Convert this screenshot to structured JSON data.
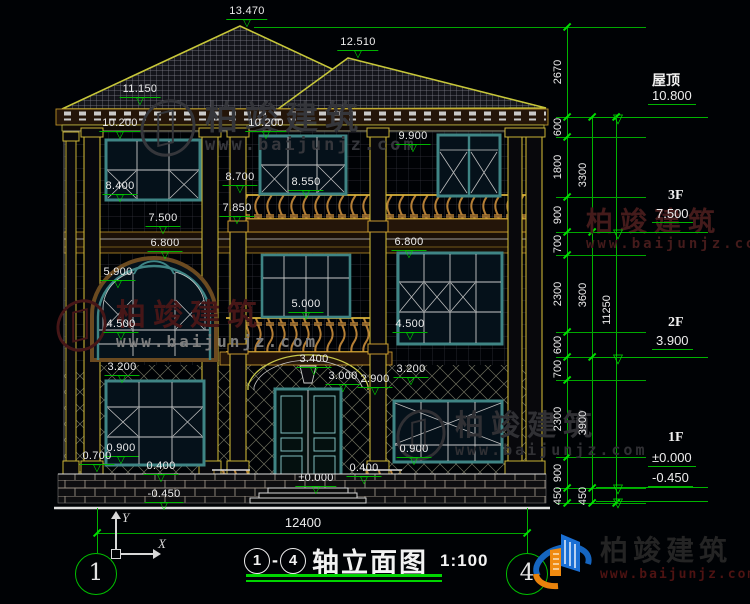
{
  "page": {
    "background": "#000205"
  },
  "brand": {
    "name": "柏竣建筑",
    "url": "www.baijunjz.com"
  },
  "title_block": {
    "axis_from": "1",
    "axis_to": "4",
    "separator": "-",
    "title": "轴立面图",
    "scale": "1:100"
  },
  "ucs": {
    "y_label": "Y",
    "x_label": "X"
  },
  "bottom_dim": {
    "label": "12400",
    "x1": 97,
    "x2": 527,
    "y": 533,
    "label_cx": 303,
    "label_y": 515
  },
  "axis_bubbles": [
    {
      "label": "1",
      "cx": 95,
      "cy": 573
    },
    {
      "label": "4",
      "cx": 526,
      "cy": 573
    }
  ],
  "elevation_marks": [
    {
      "label": "13.470",
      "cx": 247,
      "ty": 5
    },
    {
      "label": "12.510",
      "cx": 358,
      "ty": 36
    },
    {
      "label": "11.150",
      "cx": 140,
      "ty": 83
    },
    {
      "label": "10.200",
      "cx": 120,
      "ty": 117
    },
    {
      "label": "10.200",
      "cx": 266,
      "ty": 117
    },
    {
      "label": "9.900",
      "cx": 413,
      "ty": 130
    },
    {
      "label": "8.700",
      "cx": 240,
      "ty": 171
    },
    {
      "label": "8.550",
      "cx": 306,
      "ty": 176
    },
    {
      "label": "8.400",
      "cx": 120,
      "ty": 180
    },
    {
      "label": "7.850",
      "cx": 237,
      "ty": 202
    },
    {
      "label": "7.500",
      "cx": 163,
      "ty": 212
    },
    {
      "label": "6.800",
      "cx": 165,
      "ty": 237
    },
    {
      "label": "6.800",
      "cx": 409,
      "ty": 236
    },
    {
      "label": "5.900",
      "cx": 118,
      "ty": 266
    },
    {
      "label": "5.000",
      "cx": 306,
      "ty": 298
    },
    {
      "label": "4.500",
      "cx": 121,
      "ty": 318
    },
    {
      "label": "4.500",
      "cx": 410,
      "ty": 318
    },
    {
      "label": "3.400",
      "cx": 314,
      "ty": 353
    },
    {
      "label": "3.200",
      "cx": 122,
      "ty": 361
    },
    {
      "label": "3.200",
      "cx": 411,
      "ty": 363
    },
    {
      "label": "3.000",
      "cx": 343,
      "ty": 370
    },
    {
      "label": "2.900",
      "cx": 375,
      "ty": 373
    },
    {
      "label": "0.900",
      "cx": 121,
      "ty": 442
    },
    {
      "label": "0.900",
      "cx": 414,
      "ty": 443
    },
    {
      "label": "0.700",
      "cx": 97,
      "ty": 450
    },
    {
      "label": "0.400",
      "cx": 161,
      "ty": 460
    },
    {
      "label": "0.400",
      "cx": 364,
      "ty": 462
    },
    {
      "label": "±0.000",
      "cx": 316,
      "ty": 472
    },
    {
      "label": "-0.450",
      "cx": 164,
      "ty": 488
    }
  ],
  "floor_markers": [
    {
      "name": "屋顶",
      "name_x": 652,
      "name_y": 70,
      "rows": [
        {
          "value": "10.800",
          "x": 648,
          "y": 88,
          "marker_y": 117
        }
      ]
    },
    {
      "name": "3F",
      "name_x": 668,
      "name_y": 188,
      "rows": [
        {
          "value": "7.500",
          "x": 652,
          "y": 206,
          "marker_y": 232
        }
      ]
    },
    {
      "name": "2F",
      "name_x": 668,
      "name_y": 315,
      "rows": [
        {
          "value": "3.900",
          "x": 652,
          "y": 333,
          "marker_y": 357
        }
      ]
    },
    {
      "name": "1F",
      "name_x": 668,
      "name_y": 430,
      "rows": [
        {
          "value": "±0.000",
          "x": 648,
          "y": 450,
          "marker_y": 487
        },
        {
          "value": "-0.450",
          "x": 648,
          "y": 470,
          "marker_y": 501
        }
      ]
    }
  ],
  "dim_chains": [
    {
      "x": 567,
      "segments": [
        {
          "label": "2670",
          "y1": 27,
          "y2": 117
        },
        {
          "label": "600",
          "y1": 117,
          "y2": 137
        },
        {
          "label": "1800",
          "y1": 137,
          "y2": 197
        },
        {
          "label": "900",
          "y1": 197,
          "y2": 232
        },
        {
          "label": "700",
          "y1": 232,
          "y2": 255
        },
        {
          "label": "2300",
          "y1": 255,
          "y2": 332
        },
        {
          "label": "600",
          "y1": 332,
          "y2": 357
        },
        {
          "label": "700",
          "y1": 357,
          "y2": 380
        },
        {
          "label": "2300",
          "y1": 380,
          "y2": 457
        },
        {
          "label": "900",
          "y1": 457,
          "y2": 488
        },
        {
          "label": "450",
          "y1": 488,
          "y2": 503
        }
      ]
    },
    {
      "x": 592,
      "segments": [
        {
          "label": "3300",
          "y1": 117,
          "y2": 232
        },
        {
          "label": "3600",
          "y1": 232,
          "y2": 357
        },
        {
          "label": "3900",
          "y1": 357,
          "y2": 488
        },
        {
          "label": "450",
          "y1": 488,
          "y2": 503
        }
      ]
    },
    {
      "x": 616,
      "segments": [
        {
          "label": "11250",
          "y1": 117,
          "y2": 503
        }
      ]
    }
  ],
  "levels": [
    27,
    117,
    137,
    197,
    232,
    255,
    332,
    357,
    380,
    457,
    488,
    503
  ],
  "watermarks": [
    {
      "x": 140,
      "y": 100,
      "size": 33,
      "color": "#35363b",
      "url_color": "#35363b",
      "logo": true
    },
    {
      "x": 56,
      "y": 300,
      "size": 30,
      "color": "#461617",
      "url_color": "#7d7d7d",
      "logo": true
    },
    {
      "x": 586,
      "y": 208,
      "size": 27,
      "color": "#441b1b",
      "url_color": "#441b1b",
      "logo": false
    },
    {
      "x": 396,
      "y": 410,
      "size": 29,
      "color": "#303034",
      "url_color": "#303034",
      "logo": true
    }
  ]
}
